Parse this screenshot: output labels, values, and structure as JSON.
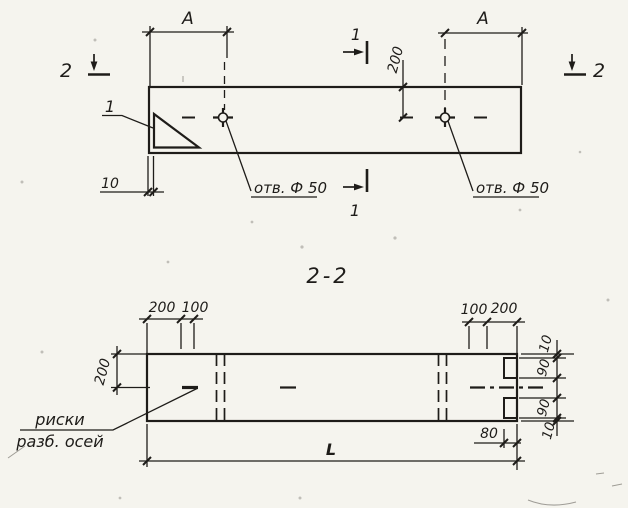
{
  "drawing": {
    "paper_color": "#f5f4ee",
    "ink_color": "#1e1c19"
  },
  "plan_view": {
    "dim_a_left": "A",
    "dim_a_right": "A",
    "dim_hole_offset": "200",
    "dim_edge_thickness": "10",
    "detail_ref": "1",
    "hole_label_left": "отв. Ф 50",
    "hole_label_right": "отв. Ф 50",
    "section1_marker_top": "1",
    "section1_marker_bottom": "1",
    "section2_marker_left": "2",
    "section2_marker_right": "2"
  },
  "section_view": {
    "title": "2-2",
    "dim_left_200": "200",
    "dim_left_100": "100",
    "dim_right_100": "100",
    "dim_right_200": "200",
    "dim_height_200": "200",
    "dim_end_10_top": "10",
    "dim_end_90_top": "90",
    "dim_end_90_bottom": "90",
    "dim_end_10_bottom": "10",
    "dim_notch_80": "80",
    "dim_length": "L",
    "axes_label_line1": "риски",
    "axes_label_line2": "разб. осей"
  }
}
